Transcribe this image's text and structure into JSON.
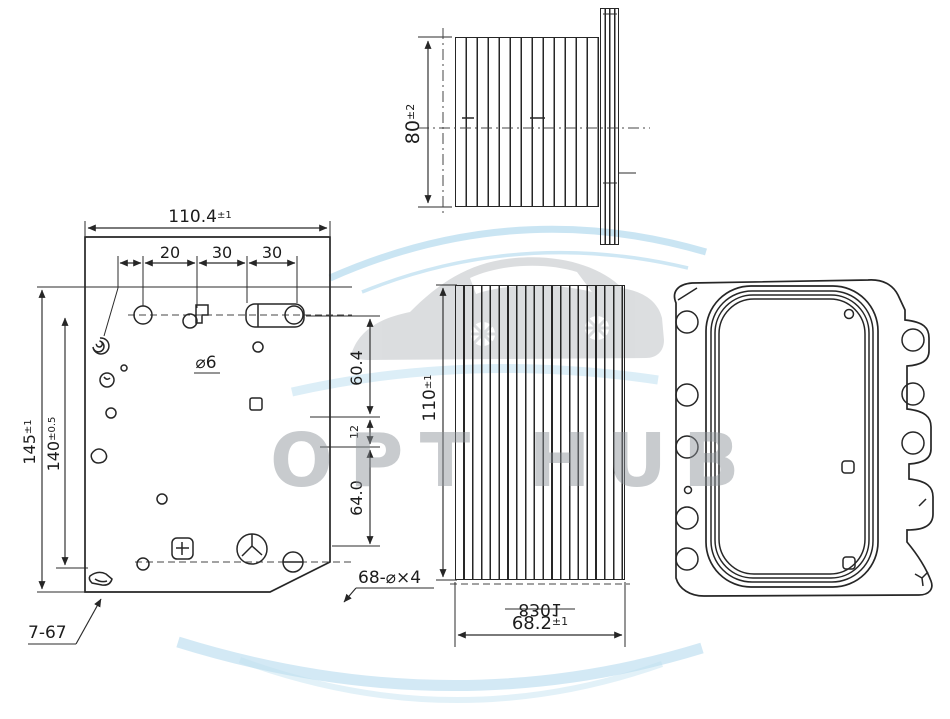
{
  "watermark": {
    "brand": "OPT HUB"
  },
  "side_view": {
    "depth": "80",
    "depth_tol": "±2"
  },
  "plate_view": {
    "width": "110.4",
    "width_tol": "±1",
    "spacings": [
      "20",
      "30",
      "30"
    ],
    "height_outer": "145",
    "height_outer_tol": "±1",
    "height_inner": "140",
    "height_inner_tol": "±0.5",
    "hole_callout": "⌀6",
    "upper_span": "60.4",
    "step": "12",
    "lower_span": "64.0",
    "bottom_callout": "7-67",
    "chamfer_callout": "68-⌀×4"
  },
  "core_view": {
    "height": "110",
    "height_tol": "±1",
    "width": "68.2",
    "width_tol": "±1",
    "width_ghost": "8301"
  }
}
